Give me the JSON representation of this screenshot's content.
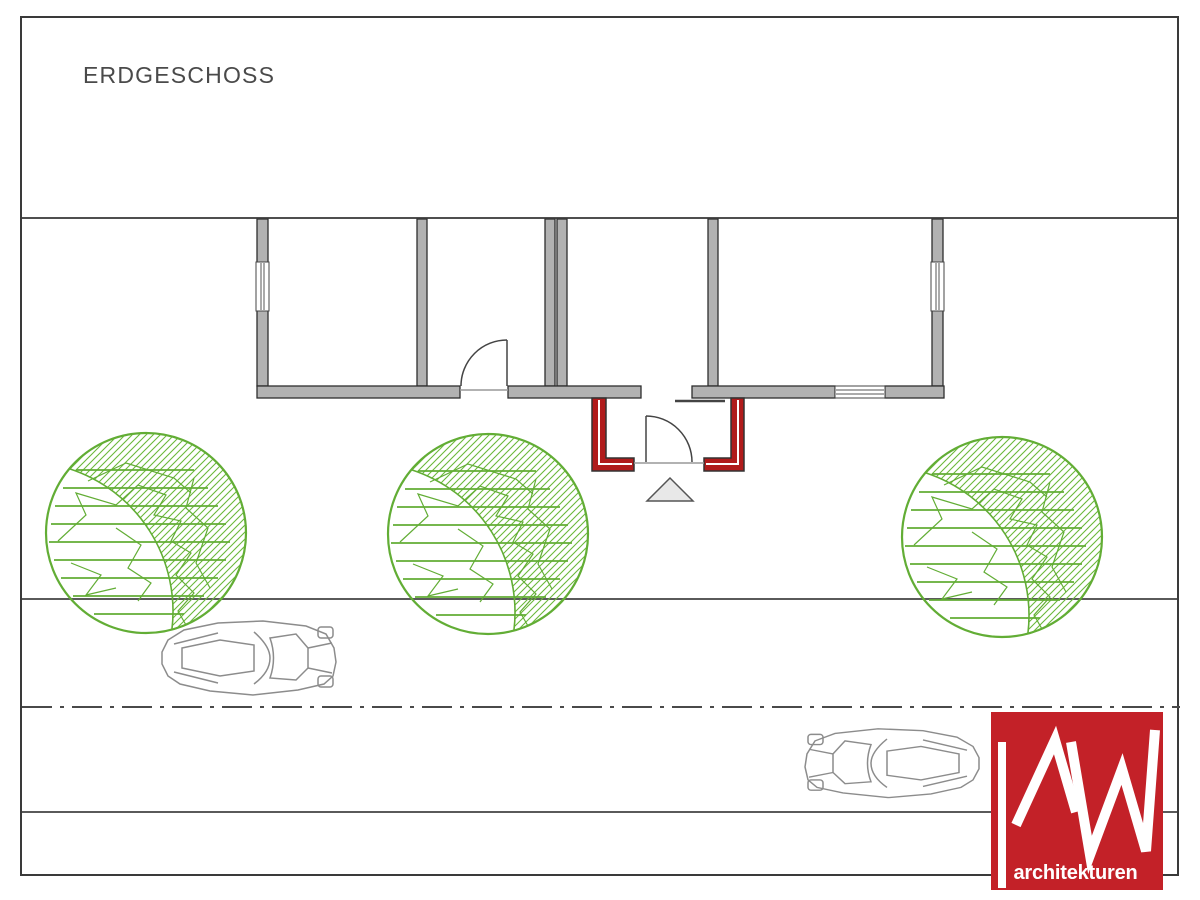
{
  "sheet": {
    "title": "ERDGESCHOSS"
  },
  "logo": {
    "monogram": "MW",
    "text": "architekturen",
    "bg_color": "#c32128",
    "fg_color": "#ffffff"
  },
  "colors": {
    "wall_fill": "#b2b2b2",
    "wall_outline": "#2e2e2e",
    "new_wall_red": "#b01b1b",
    "tree_green": "#62ad35",
    "site_line": "#4f4f4f",
    "car_outline": "#8c8c8c",
    "triangle_fill": "#e8e8e8"
  }
}
